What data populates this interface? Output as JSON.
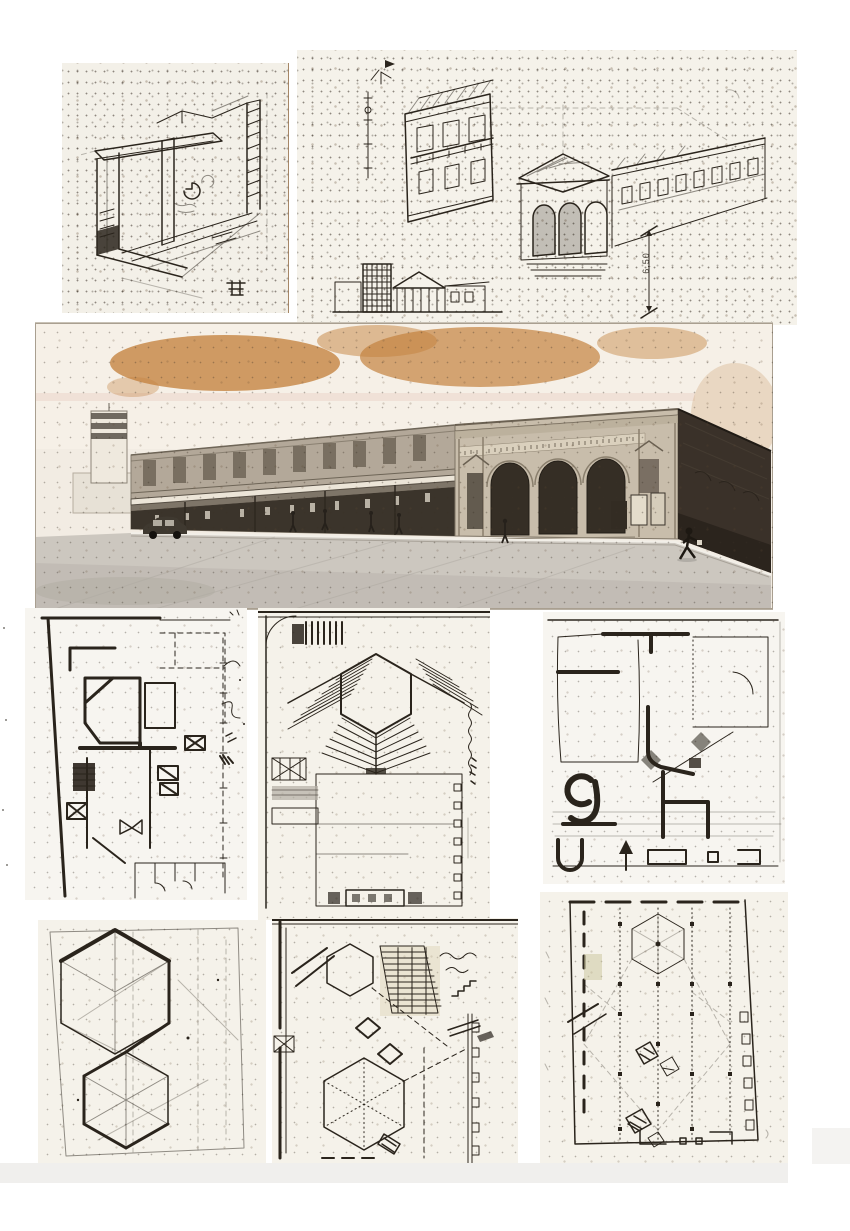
{
  "page": {
    "kind": "scanned collage of architectural study drawings and one street photograph",
    "background_color": "#ffffff",
    "paper_color": "#f5f2ea",
    "ink_color": "#2a241c",
    "stain_color": "#c4823e",
    "footer_strip_color": "#f0efed"
  },
  "figures": {
    "top_left_sketch": {
      "name": "axonometric-interior-sketch"
    },
    "top_right_sketch": {
      "name": "aerial-perspective-corner-building-sketch",
      "dimension_label": "6,50"
    },
    "street_photo": {
      "name": "street-photo-neoclassical-arched-building"
    },
    "plan_left": {
      "name": "freehand-floor-plan-heavy-ink"
    },
    "plan_center": {
      "name": "amphitheater-plan-hexagon-tiers"
    },
    "plan_right": {
      "name": "freehand-plan-sketch-with-arrow"
    },
    "hexagon_study": {
      "name": "overlapping-hexagons-geometry-study"
    },
    "hexagon_plan": {
      "name": "hexagonal-plan-with-hatching-and-notes"
    },
    "grid_plan": {
      "name": "structural-grid-plan-with-hexagon"
    }
  }
}
